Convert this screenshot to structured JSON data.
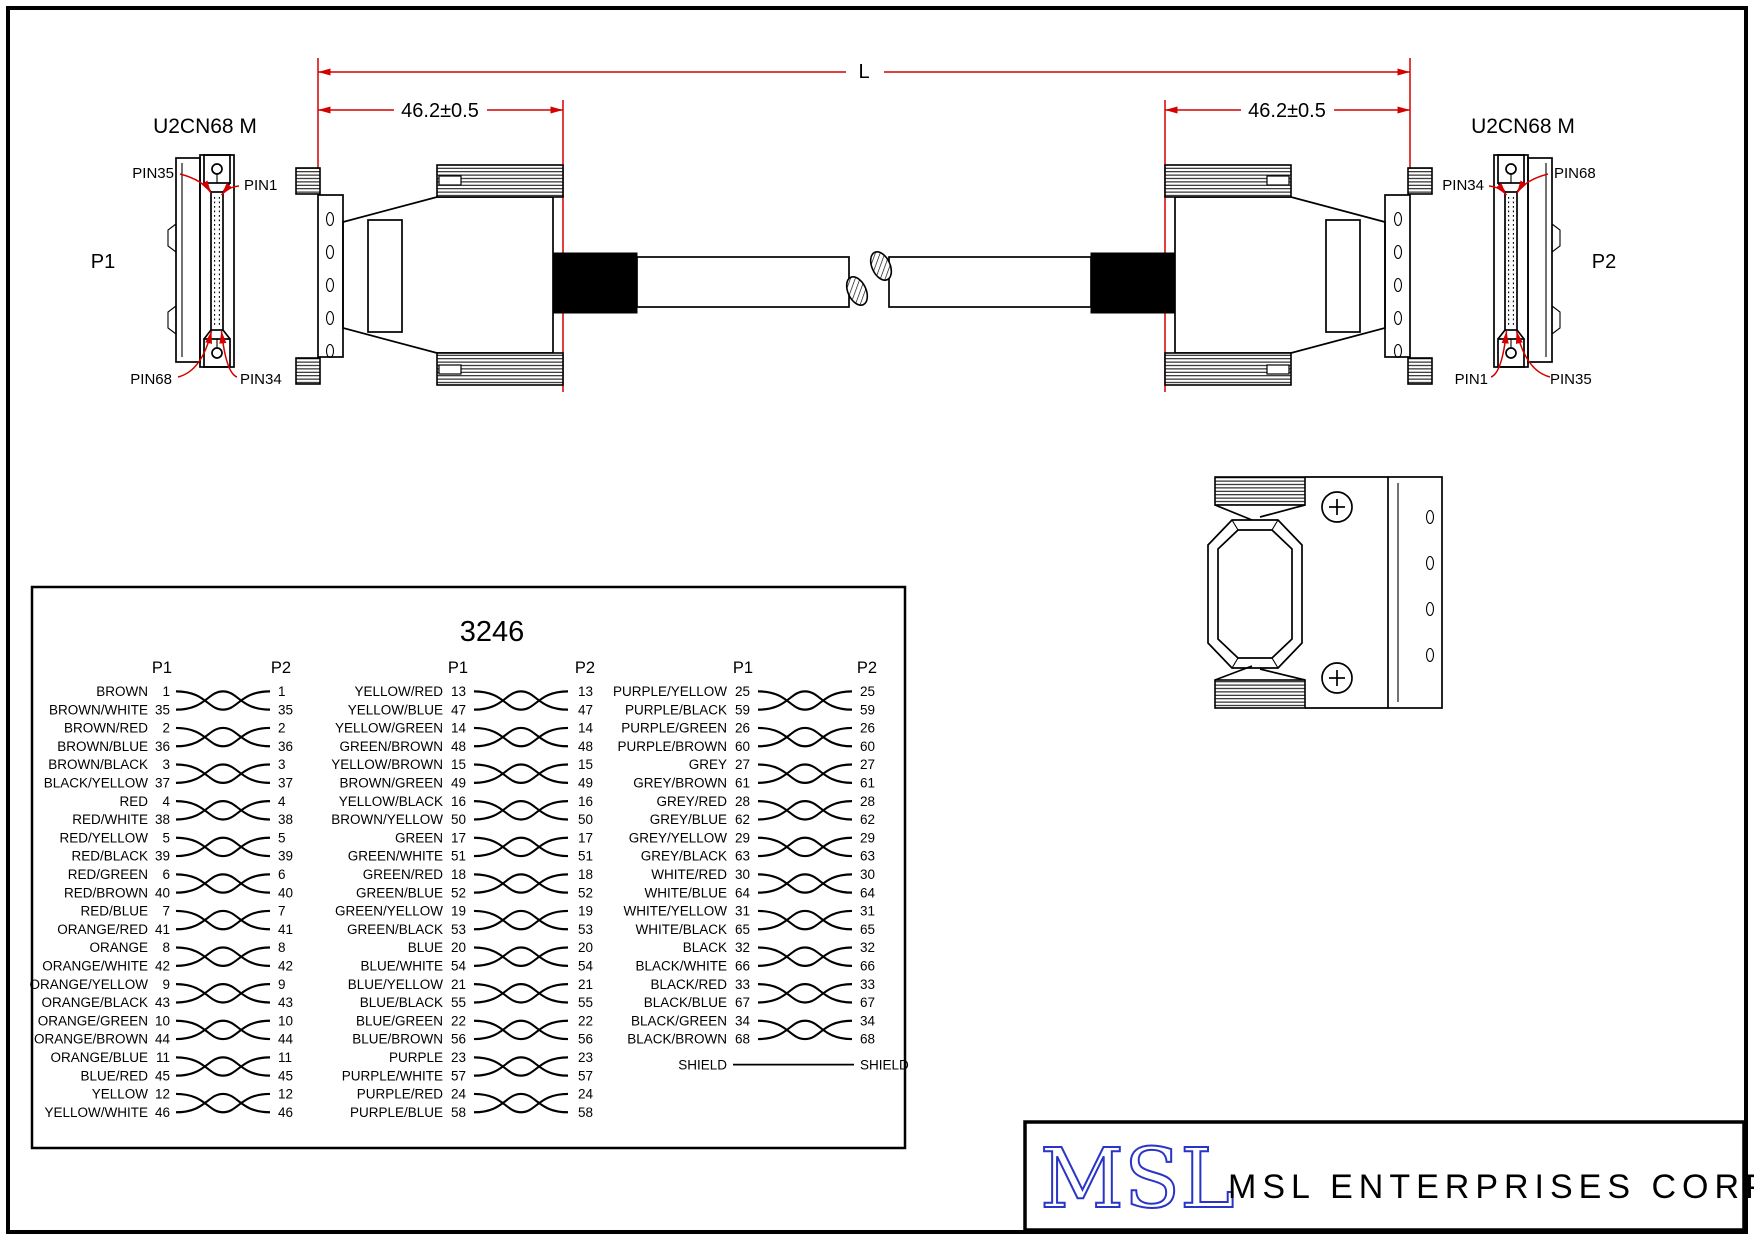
{
  "drawing": {
    "connector_label_left": "U2CN68 M",
    "connector_label_right": "U2CN68 M",
    "p1_label": "P1",
    "p2_label": "P2",
    "dim_overall": "L",
    "dim_left": "46.2±0.5",
    "dim_right": "46.2±0.5",
    "p1_pins": {
      "top_left": "PIN35",
      "top_right": "PIN1",
      "bottom_left": "PIN68",
      "bottom_right": "PIN34"
    },
    "p2_pins": {
      "top_left": "PIN34",
      "top_right": "PIN68",
      "bottom_left": "PIN1",
      "bottom_right": "PIN35"
    }
  },
  "wiring_table": {
    "title": "3246",
    "p1_header": "P1",
    "p2_header": "P2",
    "shield_left": "SHIELD",
    "shield_right": "SHIELD",
    "groups": [
      {
        "pairs": [
          {
            "wires": [
              {
                "name": "BROWN",
                "p1": 1,
                "p2": 1
              },
              {
                "name": "BROWN/WHITE",
                "p1": 35,
                "p2": 35
              }
            ]
          },
          {
            "wires": [
              {
                "name": "BROWN/RED",
                "p1": 2,
                "p2": 2
              },
              {
                "name": "BROWN/BLUE",
                "p1": 36,
                "p2": 36
              }
            ]
          },
          {
            "wires": [
              {
                "name": "BROWN/BLACK",
                "p1": 3,
                "p2": 3
              },
              {
                "name": "BLACK/YELLOW",
                "p1": 37,
                "p2": 37
              }
            ]
          },
          {
            "wires": [
              {
                "name": "RED",
                "p1": 4,
                "p2": 4
              },
              {
                "name": "RED/WHITE",
                "p1": 38,
                "p2": 38
              }
            ]
          },
          {
            "wires": [
              {
                "name": "RED/YELLOW",
                "p1": 5,
                "p2": 5
              },
              {
                "name": "RED/BLACK",
                "p1": 39,
                "p2": 39
              }
            ]
          },
          {
            "wires": [
              {
                "name": "RED/GREEN",
                "p1": 6,
                "p2": 6
              },
              {
                "name": "RED/BROWN",
                "p1": 40,
                "p2": 40
              }
            ]
          },
          {
            "wires": [
              {
                "name": "RED/BLUE",
                "p1": 7,
                "p2": 7
              },
              {
                "name": "ORANGE/RED",
                "p1": 41,
                "p2": 41
              }
            ]
          },
          {
            "wires": [
              {
                "name": "ORANGE",
                "p1": 8,
                "p2": 8
              },
              {
                "name": "ORANGE/WHITE",
                "p1": 42,
                "p2": 42
              }
            ]
          },
          {
            "wires": [
              {
                "name": "ORANGE/YELLOW",
                "p1": 9,
                "p2": 9
              },
              {
                "name": "ORANGE/BLACK",
                "p1": 43,
                "p2": 43
              }
            ]
          },
          {
            "wires": [
              {
                "name": "ORANGE/GREEN",
                "p1": 10,
                "p2": 10
              },
              {
                "name": "ORANGE/BROWN",
                "p1": 44,
                "p2": 44
              }
            ]
          },
          {
            "wires": [
              {
                "name": "ORANGE/BLUE",
                "p1": 11,
                "p2": 11
              },
              {
                "name": "BLUE/RED",
                "p1": 45,
                "p2": 45
              }
            ]
          },
          {
            "wires": [
              {
                "name": "YELLOW",
                "p1": 12,
                "p2": 12
              },
              {
                "name": "YELLOW/WHITE",
                "p1": 46,
                "p2": 46
              }
            ]
          }
        ]
      },
      {
        "pairs": [
          {
            "wires": [
              {
                "name": "YELLOW/RED",
                "p1": 13,
                "p2": 13
              },
              {
                "name": "YELLOW/BLUE",
                "p1": 47,
                "p2": 47
              }
            ]
          },
          {
            "wires": [
              {
                "name": "YELLOW/GREEN",
                "p1": 14,
                "p2": 14
              },
              {
                "name": "GREEN/BROWN",
                "p1": 48,
                "p2": 48
              }
            ]
          },
          {
            "wires": [
              {
                "name": "YELLOW/BROWN",
                "p1": 15,
                "p2": 15
              },
              {
                "name": "BROWN/GREEN",
                "p1": 49,
                "p2": 49
              }
            ]
          },
          {
            "wires": [
              {
                "name": "YELLOW/BLACK",
                "p1": 16,
                "p2": 16
              },
              {
                "name": "BROWN/YELLOW",
                "p1": 50,
                "p2": 50
              }
            ]
          },
          {
            "wires": [
              {
                "name": "GREEN",
                "p1": 17,
                "p2": 17
              },
              {
                "name": "GREEN/WHITE",
                "p1": 51,
                "p2": 51
              }
            ]
          },
          {
            "wires": [
              {
                "name": "GREEN/RED",
                "p1": 18,
                "p2": 18
              },
              {
                "name": "GREEN/BLUE",
                "p1": 52,
                "p2": 52
              }
            ]
          },
          {
            "wires": [
              {
                "name": "GREEN/YELLOW",
                "p1": 19,
                "p2": 19
              },
              {
                "name": "GREEN/BLACK",
                "p1": 53,
                "p2": 53
              }
            ]
          },
          {
            "wires": [
              {
                "name": "BLUE",
                "p1": 20,
                "p2": 20
              },
              {
                "name": "BLUE/WHITE",
                "p1": 54,
                "p2": 54
              }
            ]
          },
          {
            "wires": [
              {
                "name": "BLUE/YELLOW",
                "p1": 21,
                "p2": 21
              },
              {
                "name": "BLUE/BLACK",
                "p1": 55,
                "p2": 55
              }
            ]
          },
          {
            "wires": [
              {
                "name": "BLUE/GREEN",
                "p1": 22,
                "p2": 22
              },
              {
                "name": "BLUE/BROWN",
                "p1": 56,
                "p2": 56
              }
            ]
          },
          {
            "wires": [
              {
                "name": "PURPLE",
                "p1": 23,
                "p2": 23
              },
              {
                "name": "PURPLE/WHITE",
                "p1": 57,
                "p2": 57
              }
            ]
          },
          {
            "wires": [
              {
                "name": "PURPLE/RED",
                "p1": 24,
                "p2": 24
              },
              {
                "name": "PURPLE/BLUE",
                "p1": 58,
                "p2": 58
              }
            ]
          }
        ]
      },
      {
        "pairs": [
          {
            "wires": [
              {
                "name": "PURPLE/YELLOW",
                "p1": 25,
                "p2": 25
              },
              {
                "name": "PURPLE/BLACK",
                "p1": 59,
                "p2": 59
              }
            ]
          },
          {
            "wires": [
              {
                "name": "PURPLE/GREEN",
                "p1": 26,
                "p2": 26
              },
              {
                "name": "PURPLE/BROWN",
                "p1": 60,
                "p2": 60
              }
            ]
          },
          {
            "wires": [
              {
                "name": "GREY",
                "p1": 27,
                "p2": 27
              },
              {
                "name": "GREY/BROWN",
                "p1": 61,
                "p2": 61
              }
            ]
          },
          {
            "wires": [
              {
                "name": "GREY/RED",
                "p1": 28,
                "p2": 28
              },
              {
                "name": "GREY/BLUE",
                "p1": 62,
                "p2": 62
              }
            ]
          },
          {
            "wires": [
              {
                "name": "GREY/YELLOW",
                "p1": 29,
                "p2": 29
              },
              {
                "name": "GREY/BLACK",
                "p1": 63,
                "p2": 63
              }
            ]
          },
          {
            "wires": [
              {
                "name": "WHITE/RED",
                "p1": 30,
                "p2": 30
              },
              {
                "name": "WHITE/BLUE",
                "p1": 64,
                "p2": 64
              }
            ]
          },
          {
            "wires": [
              {
                "name": "WHITE/YELLOW",
                "p1": 31,
                "p2": 31
              },
              {
                "name": "WHITE/BLACK",
                "p1": 65,
                "p2": 65
              }
            ]
          },
          {
            "wires": [
              {
                "name": "BLACK",
                "p1": 32,
                "p2": 32
              },
              {
                "name": "BLACK/WHITE",
                "p1": 66,
                "p2": 66
              }
            ]
          },
          {
            "wires": [
              {
                "name": "BLACK/RED",
                "p1": 33,
                "p2": 33
              },
              {
                "name": "BLACK/BLUE",
                "p1": 67,
                "p2": 67
              }
            ]
          },
          {
            "wires": [
              {
                "name": "BLACK/GREEN",
                "p1": 34,
                "p2": 34
              },
              {
                "name": "BLACK/BROWN",
                "p1": 68,
                "p2": 68
              }
            ]
          }
        ]
      }
    ]
  },
  "title_block": {
    "logo": "MSL",
    "company": "MSL ENTERPRISES CORP."
  },
  "colors": {
    "dimension_red": "#d40000",
    "logo_blue": "#2a35c8",
    "line_black": "#000000"
  }
}
